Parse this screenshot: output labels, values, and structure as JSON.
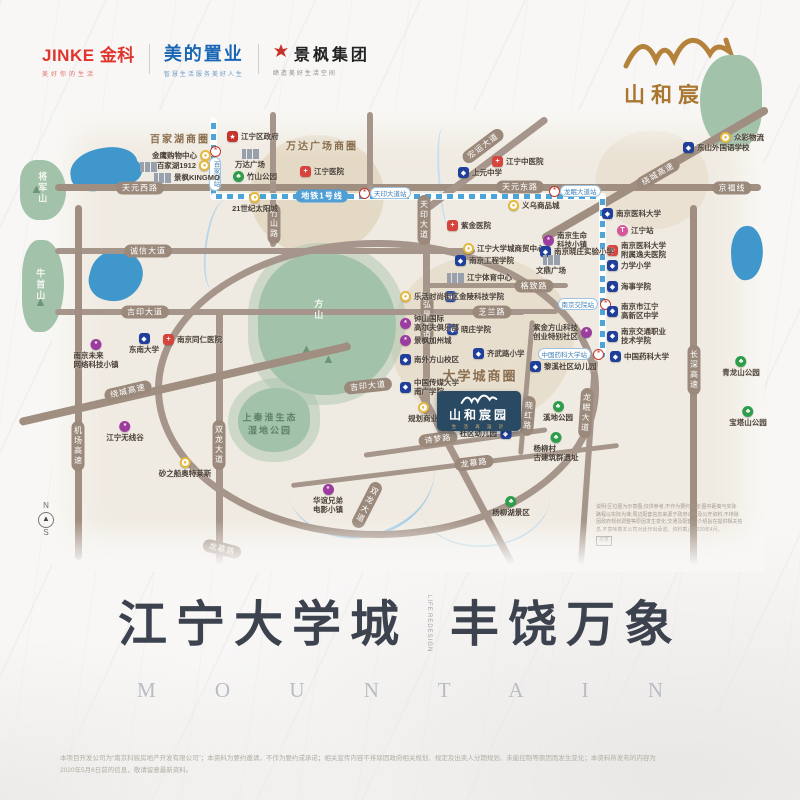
{
  "header": {
    "jinke": {
      "en": "JINKE",
      "cn": "金科",
      "tagline": "美好你的生活"
    },
    "midea": {
      "name": "美的置业",
      "tagline": "智慧生活服务美好人生"
    },
    "jingfeng": {
      "name": "景枫集团",
      "tagline": "缔造美好生活空间"
    },
    "brand": {
      "name": "山和宸园",
      "slogan": "生 活 再 設 計"
    }
  },
  "map": {
    "metro_label": "地铁1号线",
    "area_labels": [
      {
        "text": "百家湖商圈",
        "x": 180,
        "y": 138,
        "size": 10
      },
      {
        "text": "万达广场商圈",
        "x": 322,
        "y": 145,
        "size": 10
      },
      {
        "text": "大学城商圈",
        "x": 480,
        "y": 375,
        "size": 13
      }
    ],
    "terrain_labels": [
      {
        "text": "将军山",
        "x": 42,
        "y": 188,
        "v": true
      },
      {
        "text": "牛首山",
        "x": 40,
        "y": 285,
        "v": true
      },
      {
        "text": "方山",
        "x": 318,
        "y": 310,
        "v": true
      },
      {
        "text": "上秦淮生态|湿地公园",
        "x": 270,
        "y": 424,
        "dark": true
      }
    ],
    "road_labels": [
      {
        "t": "天元西路",
        "x": 140,
        "y": 188
      },
      {
        "t": "天元东路",
        "x": 520,
        "y": 187
      },
      {
        "t": "京福线",
        "x": 732,
        "y": 188
      },
      {
        "t": "诚信大道",
        "x": 148,
        "y": 251
      },
      {
        "t": "吉印大道",
        "x": 145,
        "y": 312
      },
      {
        "t": "吉印大道",
        "x": 368,
        "y": 386,
        "rot": -6
      },
      {
        "t": "格致路",
        "x": 534,
        "y": 286
      },
      {
        "t": "芝兰路",
        "x": 492,
        "y": 312
      },
      {
        "t": "诗梦路",
        "x": 438,
        "y": 439,
        "rot": -8
      },
      {
        "t": "龙慕路",
        "x": 474,
        "y": 463,
        "rot": -7
      },
      {
        "t": "龙慕路",
        "x": 222,
        "y": 549,
        "rot": 14
      },
      {
        "t": "绕城高速",
        "x": 128,
        "y": 391,
        "rot": -13
      },
      {
        "t": "绕城高速",
        "x": 658,
        "y": 174,
        "rot": -30
      },
      {
        "t": "宏运大道",
        "x": 483,
        "y": 146,
        "rot": -37
      },
      {
        "t": "竹山路",
        "x": 274,
        "y": 224,
        "v": 1
      },
      {
        "t": "天印大道",
        "x": 424,
        "y": 220,
        "v": 1
      },
      {
        "t": "弘景大道",
        "x": 427,
        "y": 320,
        "v": 1
      },
      {
        "t": "双龙大道",
        "x": 219,
        "y": 445,
        "v": 1
      },
      {
        "t": "双龙大道",
        "x": 367,
        "y": 505,
        "v": 1,
        "rot": 27
      },
      {
        "t": "机场高速",
        "x": 78,
        "y": 446,
        "v": 1
      },
      {
        "t": "长深高速",
        "x": 694,
        "y": 370,
        "v": 1
      },
      {
        "t": "龙眠大道",
        "x": 586,
        "y": 413,
        "v": 1,
        "rot": 4
      },
      {
        "t": "晓红路",
        "x": 528,
        "y": 416,
        "v": 1,
        "rot": 5
      }
    ],
    "stations": [
      {
        "label": "百家湖站",
        "x": 214,
        "y": 150,
        "p": "belowv"
      },
      {
        "label": "天印大道站",
        "x": 363,
        "y": 192
      },
      {
        "label": "龙眠大道站",
        "x": 553,
        "y": 190
      },
      {
        "label": "南京交院站",
        "x": 604,
        "y": 303,
        "p": "left"
      },
      {
        "label": "中国药科大学站",
        "x": 597,
        "y": 353,
        "p": "left"
      }
    ],
    "landmarks": [
      {
        "t": "gov",
        "x": 233,
        "y": 137,
        "l": "江宁区政府"
      },
      {
        "t": "bld",
        "x": 146,
        "y": 166,
        "l": ""
      },
      {
        "t": "shop",
        "x": 205,
        "y": 156,
        "l": "金鹰购物中心",
        "p": "left"
      },
      {
        "t": "shop",
        "x": 204,
        "y": 166,
        "l": "百家湖1912",
        "p": "left"
      },
      {
        "t": "bld",
        "x": 160,
        "y": 177,
        "l": "景枫KINGMO",
        "p": "right"
      },
      {
        "t": "bld",
        "x": 248,
        "y": 153,
        "l": "万达广场",
        "p": "below"
      },
      {
        "t": "park",
        "x": 239,
        "y": 177,
        "l": "竹山公园"
      },
      {
        "t": "shop",
        "x": 253,
        "y": 198,
        "l": "21世纪太阳城",
        "p": "below"
      },
      {
        "t": "hosp",
        "x": 306,
        "y": 172,
        "l": "江宁医院"
      },
      {
        "t": "hosp",
        "x": 498,
        "y": 162,
        "l": "江宁中医院"
      },
      {
        "t": "school",
        "x": 464,
        "y": 173,
        "l": "上元中学"
      },
      {
        "t": "shop",
        "x": 514,
        "y": 206,
        "l": "义乌商品城"
      },
      {
        "t": "shop",
        "x": 726,
        "y": 138,
        "l": "众彩物流"
      },
      {
        "t": "school",
        "x": 689,
        "y": 148,
        "l": "东山外国语学校"
      },
      {
        "t": "school",
        "x": 608,
        "y": 214,
        "l": "南京医科大学"
      },
      {
        "t": "train",
        "x": 623,
        "y": 231,
        "l": "江宁站"
      },
      {
        "t": "hosp",
        "x": 613,
        "y": 247,
        "l": "南京医科大学",
        "l2": "附属逸夫医院"
      },
      {
        "t": "school",
        "x": 613,
        "y": 266,
        "l": "力学小学"
      },
      {
        "t": "school",
        "x": 613,
        "y": 287,
        "l": "海事学院"
      },
      {
        "t": "school",
        "x": 613,
        "y": 308,
        "l": "南京市江宁",
        "l2": "高新区中学"
      },
      {
        "t": "school",
        "x": 613,
        "y": 333,
        "l": "南京交通职业",
        "l2": "技术学院"
      },
      {
        "t": "school",
        "x": 616,
        "y": 357,
        "l": "中国药科大学"
      },
      {
        "t": "hosp",
        "x": 453,
        "y": 226,
        "l": "紫金医院"
      },
      {
        "t": "shop",
        "x": 469,
        "y": 249,
        "l": "江宁大学城商贸中心"
      },
      {
        "t": "school",
        "x": 461,
        "y": 261,
        "l": "南京工程学院"
      },
      {
        "t": "bld",
        "x": 453,
        "y": 277,
        "l": "江宁体育中心"
      },
      {
        "t": "school",
        "x": 451,
        "y": 297,
        "l": "金陵科技学院"
      },
      {
        "t": "school",
        "x": 453,
        "y": 330,
        "l": "晓庄学院"
      },
      {
        "t": "biz",
        "x": 549,
        "y": 237,
        "l": "南京生命",
        "l2": "科技小镇"
      },
      {
        "t": "school",
        "x": 546,
        "y": 252,
        "l": "南京晓庄实验小学"
      },
      {
        "t": "bld",
        "x": 549,
        "y": 259,
        "l": "文鼎广场",
        "p": "below"
      },
      {
        "t": "biz",
        "x": 586,
        "y": 329,
        "l": "紫金方山科技",
        "l2": "创业特别社区",
        "p": "left"
      },
      {
        "t": "shop",
        "x": 406,
        "y": 297,
        "l": "乐活时尚街区"
      },
      {
        "t": "biz",
        "x": 406,
        "y": 320,
        "l": "钟山国际",
        "l2": "高尔夫俱乐部"
      },
      {
        "t": "biz",
        "x": 406,
        "y": 341,
        "l": "景枫加州城"
      },
      {
        "t": "school",
        "x": 406,
        "y": 360,
        "l": "南外方山校区"
      },
      {
        "t": "school",
        "x": 406,
        "y": 384,
        "l": "中国传媒大学",
        "l2": "南广学院"
      },
      {
        "t": "school",
        "x": 142,
        "y": 339,
        "l": "东南大学",
        "p": "below"
      },
      {
        "t": "hosp",
        "x": 169,
        "y": 340,
        "l": "南京同仁医院"
      },
      {
        "t": "biz",
        "x": 94,
        "y": 345,
        "l": "南京未来",
        "l2": "网络科技小镇",
        "p": "below"
      },
      {
        "t": "biz",
        "x": 123,
        "y": 427,
        "l": "江宁无线谷",
        "p": "below"
      },
      {
        "t": "shop",
        "x": 183,
        "y": 463,
        "l": "砂之船奥特莱斯",
        "p": "below"
      },
      {
        "t": "school",
        "x": 479,
        "y": 354,
        "l": "齐武路小学"
      },
      {
        "t": "school",
        "x": 536,
        "y": 367,
        "l": "黎溪社区幼儿园"
      },
      {
        "t": "shop",
        "x": 421,
        "y": 408,
        "l": "规划商业",
        "p": "below"
      },
      {
        "t": "school",
        "x": 505,
        "y": 434,
        "l": "社区幼儿园",
        "p": "left"
      },
      {
        "t": "park",
        "x": 556,
        "y": 407,
        "l": "溪地公园",
        "p": "below"
      },
      {
        "t": "park",
        "x": 554,
        "y": 438,
        "l": "杨柳村",
        "l2": "古建筑群遗址",
        "p": "below"
      },
      {
        "t": "park",
        "x": 509,
        "y": 502,
        "l": "杨柳湖景区",
        "p": "below"
      },
      {
        "t": "park",
        "x": 739,
        "y": 362,
        "l": "青龙山公园",
        "p": "below"
      },
      {
        "t": "park",
        "x": 746,
        "y": 412,
        "l": "宝塔山公园",
        "p": "below"
      },
      {
        "t": "biz",
        "x": 326,
        "y": 490,
        "l": "华谊兄弟",
        "l2": "电影小镇",
        "p": "below"
      }
    ],
    "project": {
      "name": "山和宸园",
      "slogan": "生 活 再 設 計",
      "x": 437,
      "y": 391,
      "w": 84,
      "h": 40
    },
    "compass": {
      "n": "N",
      "s": "S",
      "x": 38,
      "y": 502
    },
    "note_lines": [
      "说明:区位图为示意图,仅供参考,不作为要约内容;图中距离与实际",
      "路程以实际为准;周边配套信息来源于政府公示及公开资料,不排除",
      "因政府规划调整等原因发生变化;交通及配套的介绍旨在提供相关信",
      "息,不意味着本公司对此作出承诺。资料截止 2020年4月。"
    ],
    "note_tag": "示意"
  },
  "headline": {
    "part1": "江宁大学城",
    "divider1": "LIFE",
    "divider2": "REDESIGN",
    "part2": "丰饶万象",
    "en": "M O U N T A I N"
  },
  "footer": {
    "line1": "本项目开发公司为“南京科宸房地产开发有限公司”；本资料为要约邀请，不作为要约或承诺；相关宣传内容不排除因政府相关规划、规定及出卖人分期规划、未能控制等原因而发生变化；本资料所发布的内容为",
    "line2": "2020年5月6日前的信息，敬请留意最新资料。"
  },
  "colors": {
    "brand_gold": "#a8762f",
    "project_navy": "#2a4a63",
    "metro_blue": "#4da4d8",
    "road_taupe": "#a6958a",
    "school_blue": "#1f3f9a",
    "hospital_red": "#d6453d",
    "park_green": "#2f9e4a",
    "shop_gold": "#e6b83f",
    "biz_purple": "#9c3c9e",
    "train_pink": "#d8569b",
    "lake_blue": "#3f97cc",
    "hill_green": "#a3c2aa"
  }
}
